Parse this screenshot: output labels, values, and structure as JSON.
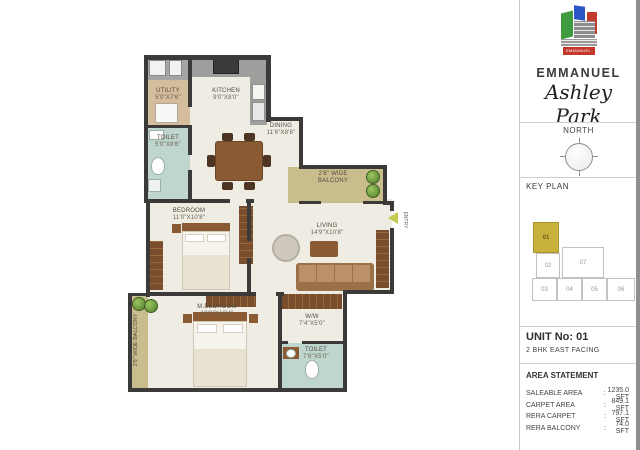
{
  "brand": {
    "logo_banner": "EMMANUEL",
    "name": "EMMANUEL",
    "project": "Ashley Park"
  },
  "compass": {
    "label": "NORTH"
  },
  "key_plan": {
    "title": "KEY PLAN",
    "units": [
      "01",
      "02",
      "07",
      "03",
      "04",
      "05",
      "06"
    ],
    "highlighted_unit": "01"
  },
  "unit_info": {
    "number": "UNIT No: 01",
    "type": "2 BHK  EAST FACING"
  },
  "area_statement": {
    "title": "AREA STATEMENT",
    "colon": ":",
    "rows": [
      {
        "label": "SALEABLE AREA",
        "value": "1235.0 SFT"
      },
      {
        "label": "CARPET AREA",
        "value": "849.1 SFT"
      },
      {
        "label": "RERA CARPET",
        "value": "797.1 SFT"
      },
      {
        "label": "RERA BALCONY",
        "value": "74.0 SFT"
      }
    ]
  },
  "plan": {
    "rooms": [
      {
        "name": "UTILITY",
        "dim": "5'0\"X7'6\""
      },
      {
        "name": "KITCHEN",
        "dim": "9'0\"X8'0\""
      },
      {
        "name": "TOILET",
        "dim": "5'0\"X8'6\""
      },
      {
        "name": "DINING",
        "dim": "11'6\"X8'6\""
      },
      {
        "name": "BEDROOM",
        "dim": "11'0\"X10'8\""
      },
      {
        "name": "LIVING",
        "dim": "14'9\"X10'8\""
      },
      {
        "name": "M.BEDROOM",
        "dim": "13'0\"X10'4\""
      },
      {
        "name": "W/W",
        "dim": "7'4\"X5'0\""
      },
      {
        "name": "TOILET",
        "dim": "7'6\"X5'0\""
      }
    ],
    "balcony_top": "2'6\" WIDE BALCONY",
    "balcony_left": "2'6\" WIDE BALCONY",
    "entry": "ENTRY"
  },
  "colors": {
    "wall": "#3c3a38",
    "floor": "#efece4",
    "utility_floor": "#d4bd9c",
    "toilet_floor": "#bfd6cf",
    "balcony_floor": "#c9bc8d",
    "counter": "#9e9e9c",
    "wood": "#8a5a33",
    "keyplan_highlight": "#c9b23c",
    "entry_arrow": "#c3cc4e"
  }
}
